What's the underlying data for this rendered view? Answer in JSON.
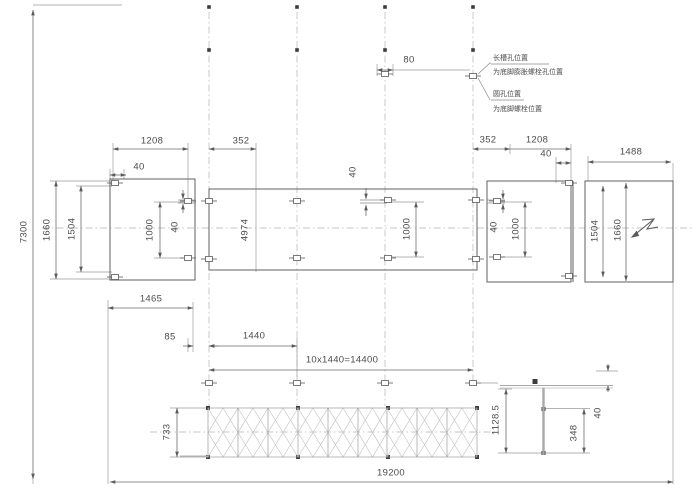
{
  "drawing": {
    "type": "foundation-anchor-bolt-layout-plan",
    "colors": {
      "line": "#6e6e6e",
      "dim_line": "#787878",
      "text": "#4c4c4c",
      "centerline": "#b3b3b3",
      "hatch": "#c6c6c6",
      "node": "#3c3c3c",
      "background": "#ffffff"
    },
    "notes": {
      "long_slot_title": "长槽孔位置",
      "long_slot_desc": "为底脚膨胀螺栓孔位置",
      "round_hole_title": "圆孔位置",
      "round_hole_desc": "为底脚螺栓位置"
    },
    "dims": {
      "d7300": "7300",
      "d19200": "19200",
      "d1660_l": "1660",
      "d1504_l": "1504",
      "d1208_l": "1208",
      "d352_l": "352",
      "d40_l_top": "40",
      "d1000_l": "1000",
      "d40_l_in": "40",
      "d4974": "4974",
      "d40_c": "40",
      "d1000_c": "1000",
      "d80": "80",
      "d352_r": "352",
      "d1208_r": "1208",
      "d40_r_top": "40",
      "d1488": "1488",
      "d40_r_in": "40",
      "d1000_r": "1000",
      "d1504_r": "1504",
      "d1660_r": "1660",
      "d1465": "1465",
      "d85": "85",
      "d1440": "1440",
      "d14400": "10x1440=14400",
      "d733": "733",
      "d1128_5": "1128.5",
      "d348": "348",
      "d40_b": "40"
    }
  }
}
